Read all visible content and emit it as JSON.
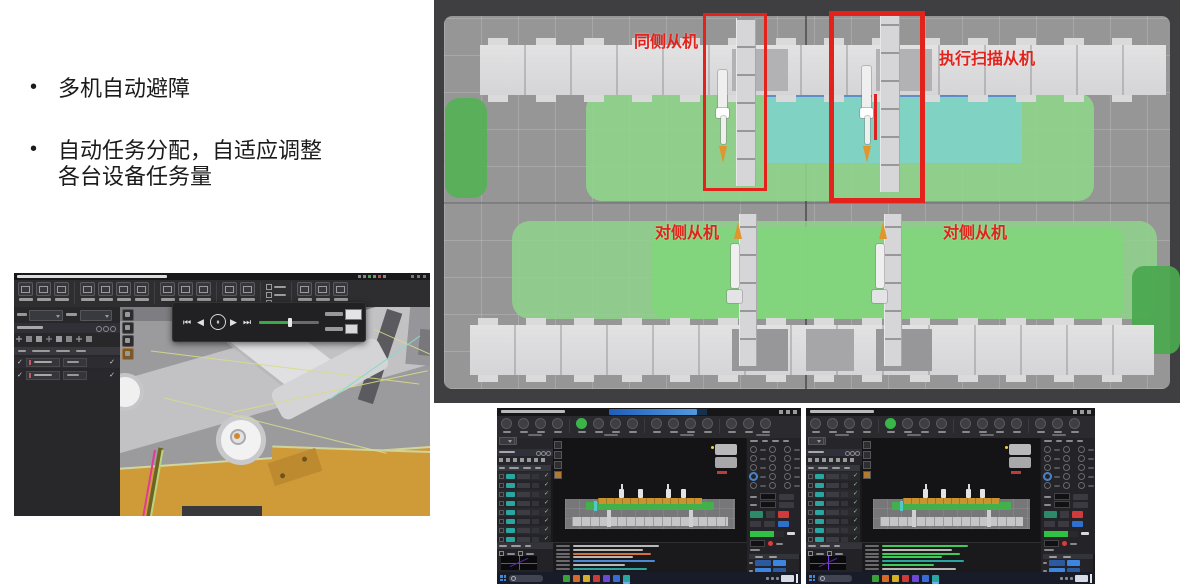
{
  "bullets": {
    "bullet_char": "•",
    "b1": "多机自动避障",
    "b2_line1": "自动任务分配，自适应调整",
    "b2_line2": "各台设备任务量"
  },
  "sim": {
    "label_same_side": "同侧从机",
    "label_scan": "执行扫描从机",
    "label_opposite_1": "对侧从机",
    "label_opposite_2": "对侧从机",
    "colors": {
      "annotation_red": "#e3221b",
      "frame": "#3f3f41",
      "floor": "#969696",
      "rail": "#d9d9db",
      "zone_green": "#8fd78a",
      "zone_green_inner": "#82d47c",
      "zone_green_dark_left": "#55b156",
      "zone_green_dark_right": "#4aa84e",
      "zone_teal": "#7fd3c5",
      "blue_strip": "#5b7fd4",
      "mini_green": "#2fb44a",
      "scan_beam": "#e02020",
      "robot_orange": "#e0952f"
    }
  },
  "robot_app": {
    "media": {
      "skip_start": "⏮",
      "prev": "◀",
      "pause": "⏸",
      "play": "▶",
      "skip_end": "⏭"
    },
    "check": "✓",
    "ribbon_groups": [
      3,
      4,
      3,
      2
    ],
    "left_table_rows": 2,
    "slider_fill_pct": 52,
    "viewport_colors": {
      "wing_orange": "#cf9b39",
      "crease_pink": "#e23a97",
      "path_yellow": "#d8db85",
      "path_teal": "#86d9c9"
    }
  },
  "monitors": {
    "check": "✓",
    "ribbon_icon_count": 15,
    "ribbon_green_index": 4,
    "accent_green_button": "#3bb54a",
    "teal_badge": "#2aa6a0",
    "row_check_color": "#9ed0a2",
    "blue_cell": "#3c86e0",
    "blue_cell_dark": "#2c5aa0",
    "progress_green": "#2fc144",
    "red_button": "#d03a3a",
    "machine": {
      "green_band": "#42b14b",
      "orange_beam": "#c9932f",
      "rail": "#c6c6c8",
      "platform": "#77777a"
    },
    "left_window": {
      "table_rows": 9,
      "log_colors": [
        "#b8b8b8",
        "#b8b8b8",
        "#d4713a",
        "#b8b8b8",
        "#4a8ad4",
        "#b8b8b8",
        "#2aa6a0"
      ],
      "has_blue_title": true
    },
    "right_window": {
      "table_rows": 9,
      "log_colors": [
        "#3fca5a",
        "#b8b8b8",
        "#3fca5a",
        "#3fca5a",
        "#2aa6a0",
        "#3fca5a",
        "#b8b8b8"
      ],
      "has_blue_title": false
    },
    "taskbar": {
      "windows_blue": "#3a8adf",
      "icon_colors": [
        "#3aa03a",
        "#d46a2a",
        "#d4b028",
        "#cc3a3a",
        "#6a4ad4",
        "#3a6ad4",
        "#2aa6a0"
      ]
    }
  }
}
